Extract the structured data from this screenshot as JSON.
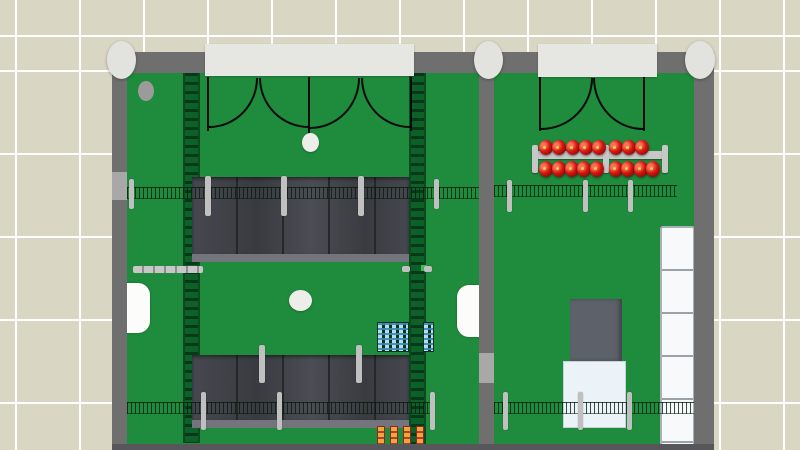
{
  "meta": {
    "view": "top-down floor plan of two rooms with furnishings",
    "viewport": "800x450",
    "visible_text": []
  },
  "palette": {
    "tile": "#d9d6c4",
    "grout": "#ffffff",
    "wall": "#6f6f6f",
    "wallLight": "#a8a8a8",
    "floor": "#1f8b3d",
    "sill": "#e6e6e3",
    "column": "#e2e2df",
    "panel1": "#47474f",
    "panel2": "#3a3a41",
    "panel3": "#4c4c54",
    "panelGap": "#26262b",
    "panelEdge": "#74747c",
    "post": "#c0c0c0",
    "fenceDark": "rgba(6,28,13,0.78)",
    "ladderBase": "#0d6128",
    "ladderRung": "#06391a",
    "ladderRail": "#0a4a1e",
    "rail": "#c7c7c7",
    "railTick": "#8d8d8d",
    "ballRed": "#d41510",
    "ballDark": "#7c0a06",
    "ballLight": "#ff7058",
    "ballDot": "#cdd848",
    "counter": "#fcfcfa",
    "whiteDot": "#ededea",
    "greenDot": "#35c455",
    "blueItem": "#aee0f0",
    "blueStripe": "rgba(63,134,184,0.9)",
    "rackBase": "#0a3317",
    "orangeItem": "#eaa83f",
    "orangeStripe": "#bf3a28",
    "orangeBorder": "#8a2a1f",
    "grayBox": "#5d626a",
    "whiteBox": "#ecf3f8",
    "whiteBoxEdge": "#c6d1d8",
    "fridge": "#f8f9fa",
    "fridgeDiv": "#9aa2a8",
    "fridgeEdge": "#a9b1b7",
    "doorLine": "#0a0a0a",
    "signGreen": "#0b4f21",
    "grayDot": "#9b9b9b",
    "bottomStrip": "#57575b"
  },
  "scene": {
    "objects": [
      {
        "n": "left-room-floor",
        "t": "r",
        "x": 127,
        "y": 72,
        "w": 352,
        "h": 378,
        "c": "floor",
        "i": false
      },
      {
        "n": "right-room-floor",
        "t": "r",
        "x": 494,
        "y": 72,
        "w": 200,
        "h": 378,
        "c": "floor",
        "i": false
      },
      {
        "n": "conveyor-strip-left",
        "t": "r",
        "x": 183,
        "y": 73,
        "w": 17,
        "h": 370,
        "c": "ladder",
        "i": true
      },
      {
        "n": "conveyor-strip-right",
        "t": "r",
        "x": 409,
        "y": 73,
        "w": 17,
        "h": 377,
        "c": "ladder",
        "i": true
      },
      {
        "n": "wall-sign",
        "t": "r",
        "x": 245,
        "y": 67,
        "w": 31,
        "h": 8,
        "c": "sign",
        "i": false
      },
      {
        "n": "floor-mark-ellipse",
        "t": "e",
        "x": 138,
        "y": 81,
        "w": 16,
        "h": 20,
        "c": "graydot",
        "i": false
      },
      {
        "n": "shelf-row-upper",
        "t": "r",
        "x": 192,
        "y": 177,
        "w": 217,
        "h": 85,
        "c": "panels",
        "i": true
      },
      {
        "n": "shelf-row-lower",
        "t": "r",
        "x": 192,
        "y": 355,
        "w": 217,
        "h": 73,
        "c": "panels",
        "i": true
      },
      {
        "n": "fence-left-upper",
        "t": "r",
        "x": 127,
        "y": 187,
        "w": 352,
        "h": 12,
        "c": "fence",
        "i": true
      },
      {
        "n": "fence-right-upper",
        "t": "r",
        "x": 494,
        "y": 185,
        "w": 183,
        "h": 12,
        "c": "fence",
        "i": true
      },
      {
        "n": "fence-left-lower",
        "t": "r",
        "x": 127,
        "y": 402,
        "w": 305,
        "h": 12,
        "c": "fence",
        "i": true
      },
      {
        "n": "fence-right-lower",
        "t": "r",
        "x": 494,
        "y": 402,
        "w": 200,
        "h": 12,
        "c": "fence",
        "i": true
      },
      {
        "n": "fence-post",
        "t": "r",
        "x": 129,
        "y": 179,
        "w": 5,
        "h": 30,
        "c": "post",
        "i": false
      },
      {
        "n": "shelf-post",
        "t": "r",
        "x": 205,
        "y": 176,
        "w": 6,
        "h": 40,
        "c": "post",
        "i": false
      },
      {
        "n": "shelf-post",
        "t": "r",
        "x": 281,
        "y": 176,
        "w": 6,
        "h": 40,
        "c": "post",
        "i": false
      },
      {
        "n": "shelf-post",
        "t": "r",
        "x": 358,
        "y": 176,
        "w": 6,
        "h": 40,
        "c": "post",
        "i": false
      },
      {
        "n": "fence-post",
        "t": "r",
        "x": 434,
        "y": 179,
        "w": 5,
        "h": 30,
        "c": "post",
        "i": false
      },
      {
        "n": "fence-post",
        "t": "r",
        "x": 507,
        "y": 180,
        "w": 5,
        "h": 32,
        "c": "post",
        "i": false
      },
      {
        "n": "fence-post",
        "t": "r",
        "x": 583,
        "y": 180,
        "w": 5,
        "h": 32,
        "c": "post",
        "i": false
      },
      {
        "n": "fence-post",
        "t": "r",
        "x": 628,
        "y": 180,
        "w": 5,
        "h": 32,
        "c": "post",
        "i": false
      },
      {
        "n": "shelf-post",
        "t": "r",
        "x": 259,
        "y": 345,
        "w": 6,
        "h": 38,
        "c": "post",
        "i": false
      },
      {
        "n": "shelf-post",
        "t": "r",
        "x": 356,
        "y": 345,
        "w": 6,
        "h": 38,
        "c": "post",
        "i": false
      },
      {
        "n": "fence-post",
        "t": "r",
        "x": 201,
        "y": 392,
        "w": 5,
        "h": 38,
        "c": "post",
        "i": false
      },
      {
        "n": "fence-post",
        "t": "r",
        "x": 277,
        "y": 392,
        "w": 5,
        "h": 38,
        "c": "post",
        "i": false
      },
      {
        "n": "fence-post",
        "t": "r",
        "x": 430,
        "y": 392,
        "w": 5,
        "h": 38,
        "c": "post",
        "i": false
      },
      {
        "n": "fence-post",
        "t": "r",
        "x": 503,
        "y": 392,
        "w": 5,
        "h": 38,
        "c": "post",
        "i": false
      },
      {
        "n": "fence-post",
        "t": "r",
        "x": 578,
        "y": 392,
        "w": 5,
        "h": 38,
        "c": "post",
        "i": false
      },
      {
        "n": "fence-post",
        "t": "r",
        "x": 627,
        "y": 392,
        "w": 5,
        "h": 38,
        "c": "post",
        "i": false
      },
      {
        "n": "display-rail",
        "t": "r",
        "x": 532,
        "y": 151,
        "w": 136,
        "h": 8,
        "c": "rail",
        "i": true
      },
      {
        "n": "rail-cap",
        "t": "r",
        "x": 532,
        "y": 145,
        "w": 6,
        "h": 28,
        "c": "railcap",
        "i": false
      },
      {
        "n": "rail-cap",
        "t": "r",
        "x": 603,
        "y": 145,
        "w": 6,
        "h": 28,
        "c": "railcap",
        "i": false
      },
      {
        "n": "rail-cap",
        "t": "r",
        "x": 662,
        "y": 145,
        "w": 6,
        "h": 28,
        "c": "railcap",
        "i": false
      },
      {
        "n": "red-ball",
        "t": "e",
        "x": 539,
        "y": 140,
        "w": 14,
        "h": 15,
        "c": "ball",
        "i": true
      },
      {
        "n": "red-ball",
        "t": "e",
        "x": 552,
        "y": 140,
        "w": 14,
        "h": 15,
        "c": "ball",
        "i": true
      },
      {
        "n": "red-ball",
        "t": "e",
        "x": 566,
        "y": 140,
        "w": 14,
        "h": 15,
        "c": "ball",
        "i": true
      },
      {
        "n": "red-ball",
        "t": "e",
        "x": 579,
        "y": 140,
        "w": 14,
        "h": 15,
        "c": "ball",
        "i": true
      },
      {
        "n": "red-ball",
        "t": "e",
        "x": 592,
        "y": 140,
        "w": 14,
        "h": 15,
        "c": "ball",
        "i": true
      },
      {
        "n": "red-ball",
        "t": "e",
        "x": 609,
        "y": 140,
        "w": 14,
        "h": 15,
        "c": "ball",
        "i": true
      },
      {
        "n": "red-ball",
        "t": "e",
        "x": 622,
        "y": 140,
        "w": 14,
        "h": 15,
        "c": "ball",
        "i": true
      },
      {
        "n": "red-ball",
        "t": "e",
        "x": 635,
        "y": 140,
        "w": 14,
        "h": 15,
        "c": "ball",
        "i": true
      },
      {
        "n": "red-ball",
        "t": "e",
        "x": 539,
        "y": 161,
        "w": 14,
        "h": 16,
        "c": "ball",
        "i": true
      },
      {
        "n": "red-ball",
        "t": "e",
        "x": 552,
        "y": 161,
        "w": 14,
        "h": 16,
        "c": "ball",
        "i": true
      },
      {
        "n": "red-ball",
        "t": "e",
        "x": 565,
        "y": 161,
        "w": 14,
        "h": 16,
        "c": "ball",
        "i": true
      },
      {
        "n": "red-ball",
        "t": "e",
        "x": 577,
        "y": 161,
        "w": 14,
        "h": 16,
        "c": "ball",
        "i": true
      },
      {
        "n": "red-ball",
        "t": "e",
        "x": 590,
        "y": 161,
        "w": 14,
        "h": 16,
        "c": "ball",
        "i": true
      },
      {
        "n": "red-ball",
        "t": "e",
        "x": 609,
        "y": 161,
        "w": 14,
        "h": 16,
        "c": "ball",
        "i": true
      },
      {
        "n": "red-ball",
        "t": "e",
        "x": 621,
        "y": 161,
        "w": 14,
        "h": 16,
        "c": "ball",
        "i": true
      },
      {
        "n": "red-ball",
        "t": "e",
        "x": 634,
        "y": 161,
        "w": 14,
        "h": 16,
        "c": "ball",
        "i": true
      },
      {
        "n": "red-ball",
        "t": "e",
        "x": 646,
        "y": 161,
        "w": 14,
        "h": 16,
        "c": "ball",
        "i": true
      },
      {
        "n": "door-leaf",
        "t": "r",
        "x": 207,
        "y": 77,
        "w": 2,
        "h": 54,
        "c": "leaf",
        "i": false
      },
      {
        "n": "door-leaf",
        "t": "r",
        "x": 308,
        "y": 77,
        "w": 2,
        "h": 57,
        "c": "leaf",
        "i": false
      },
      {
        "n": "door-leaf",
        "t": "r",
        "x": 410,
        "y": 77,
        "w": 2,
        "h": 54,
        "c": "leaf",
        "i": false
      },
      {
        "n": "door-swing-arc",
        "t": "r",
        "x": 209,
        "y": 78,
        "w": 49,
        "h": 50,
        "c": "arc-br",
        "i": false
      },
      {
        "n": "door-swing-arc",
        "t": "r",
        "x": 259,
        "y": 78,
        "w": 50,
        "h": 50,
        "c": "arc-bl",
        "i": false
      },
      {
        "n": "door-swing-arc",
        "t": "r",
        "x": 310,
        "y": 78,
        "w": 50,
        "h": 51,
        "c": "arc-br",
        "i": false
      },
      {
        "n": "door-swing-arc",
        "t": "r",
        "x": 361,
        "y": 78,
        "w": 49,
        "h": 50,
        "c": "arc-bl",
        "i": false
      },
      {
        "n": "door-leaf",
        "t": "r",
        "x": 539,
        "y": 77,
        "w": 2,
        "h": 54,
        "c": "leaf",
        "i": false
      },
      {
        "n": "door-leaf",
        "t": "r",
        "x": 643,
        "y": 77,
        "w": 2,
        "h": 54,
        "c": "leaf",
        "i": false
      },
      {
        "n": "door-swing-arc",
        "t": "r",
        "x": 541,
        "y": 78,
        "w": 52,
        "h": 52,
        "c": "arc-br",
        "i": false
      },
      {
        "n": "door-swing-arc",
        "t": "r",
        "x": 593,
        "y": 78,
        "w": 50,
        "h": 52,
        "c": "arc-bl",
        "i": false
      },
      {
        "n": "entry-floor-ellipse",
        "t": "e",
        "x": 302,
        "y": 133,
        "w": 17,
        "h": 19,
        "c": "white-dot",
        "i": false
      },
      {
        "n": "center-floor-ellipse",
        "t": "e",
        "x": 289,
        "y": 290,
        "w": 23,
        "h": 21,
        "c": "white-dot",
        "i": false
      },
      {
        "n": "wall-bumper-rail",
        "t": "r",
        "x": 133,
        "y": 266,
        "w": 70,
        "h": 7,
        "c": "rail2",
        "i": true
      },
      {
        "n": "wall-counter-left",
        "t": "r",
        "x": 125,
        "y": 283,
        "w": 25,
        "h": 50,
        "c": "counter round-right",
        "i": true
      },
      {
        "n": "wall-counter-divider",
        "t": "r",
        "x": 457,
        "y": 285,
        "w": 24,
        "h": 52,
        "c": "counter round-left",
        "i": true
      },
      {
        "n": "green-marker",
        "t": "r",
        "x": 421,
        "y": 265,
        "w": 6,
        "h": 6,
        "c": "green-dot",
        "i": false
      },
      {
        "n": "small-post-mark",
        "t": "r",
        "x": 402,
        "y": 266,
        "w": 8,
        "h": 6,
        "c": "post",
        "i": false
      },
      {
        "n": "small-post-mark",
        "t": "r",
        "x": 424,
        "y": 266,
        "w": 8,
        "h": 6,
        "c": "post",
        "i": false
      },
      {
        "n": "blue-item-rack",
        "t": "r",
        "x": 377,
        "y": 322,
        "w": 32,
        "h": 30,
        "c": "blue-rack",
        "i": true
      },
      {
        "n": "blue-item-rack",
        "t": "r",
        "x": 423,
        "y": 322,
        "w": 11,
        "h": 30,
        "c": "blue-rack",
        "i": true
      },
      {
        "n": "orange-item-strip",
        "t": "r",
        "x": 377,
        "y": 426,
        "w": 8,
        "h": 24,
        "c": "orange-strip",
        "i": true
      },
      {
        "n": "orange-item-strip",
        "t": "r",
        "x": 390,
        "y": 426,
        "w": 8,
        "h": 24,
        "c": "orange-strip",
        "i": true
      },
      {
        "n": "orange-item-strip",
        "t": "r",
        "x": 403,
        "y": 426,
        "w": 8,
        "h": 24,
        "c": "orange-strip",
        "i": true
      },
      {
        "n": "orange-item-strip",
        "t": "r",
        "x": 416,
        "y": 426,
        "w": 8,
        "h": 24,
        "c": "orange-strip",
        "i": true
      },
      {
        "n": "gray-machine-box",
        "t": "r",
        "x": 570,
        "y": 299,
        "w": 52,
        "h": 62,
        "c": "gray-box",
        "i": true
      },
      {
        "n": "white-pallet-box",
        "t": "r",
        "x": 563,
        "y": 361,
        "w": 63,
        "h": 67,
        "c": "white-box",
        "i": true
      },
      {
        "n": "fridge-display-column",
        "t": "r",
        "x": 660,
        "y": 226,
        "w": 35,
        "h": 222,
        "c": "fridge",
        "i": true
      },
      {
        "n": "top-wall",
        "t": "r",
        "x": 112,
        "y": 52,
        "w": 602,
        "h": 21,
        "c": "wall",
        "i": false
      },
      {
        "n": "left-wall",
        "t": "r",
        "x": 112,
        "y": 52,
        "w": 15,
        "h": 398,
        "c": "wall",
        "i": false
      },
      {
        "n": "divider-wall",
        "t": "r",
        "x": 479,
        "y": 52,
        "w": 15,
        "h": 398,
        "c": "wall",
        "i": false
      },
      {
        "n": "right-wall",
        "t": "r",
        "x": 694,
        "y": 52,
        "w": 20,
        "h": 398,
        "c": "wall",
        "i": false
      },
      {
        "n": "wall-light-segment",
        "t": "r",
        "x": 112,
        "y": 172,
        "w": 15,
        "h": 28,
        "c": "wall-light",
        "i": false
      },
      {
        "n": "wall-light-segment",
        "t": "r",
        "x": 479,
        "y": 353,
        "w": 15,
        "h": 30,
        "c": "wall-light",
        "i": false
      },
      {
        "n": "door-sill-left",
        "t": "r",
        "x": 205,
        "y": 44,
        "w": 209,
        "h": 32,
        "c": "sill",
        "i": true
      },
      {
        "n": "door-sill-right",
        "t": "r",
        "x": 538,
        "y": 44,
        "w": 119,
        "h": 33,
        "c": "sill",
        "i": true
      },
      {
        "n": "column-post",
        "t": "e",
        "x": 107,
        "y": 41,
        "w": 29,
        "h": 38,
        "c": "column",
        "i": false
      },
      {
        "n": "column-post",
        "t": "e",
        "x": 474,
        "y": 41,
        "w": 29,
        "h": 38,
        "c": "column",
        "i": false
      },
      {
        "n": "column-post",
        "t": "e",
        "x": 685,
        "y": 41,
        "w": 30,
        "h": 38,
        "c": "column",
        "i": false
      },
      {
        "n": "bottom-edge-strip",
        "t": "r",
        "x": 112,
        "y": 444,
        "w": 602,
        "h": 6,
        "c": "bottom-strip",
        "i": false
      }
    ]
  }
}
